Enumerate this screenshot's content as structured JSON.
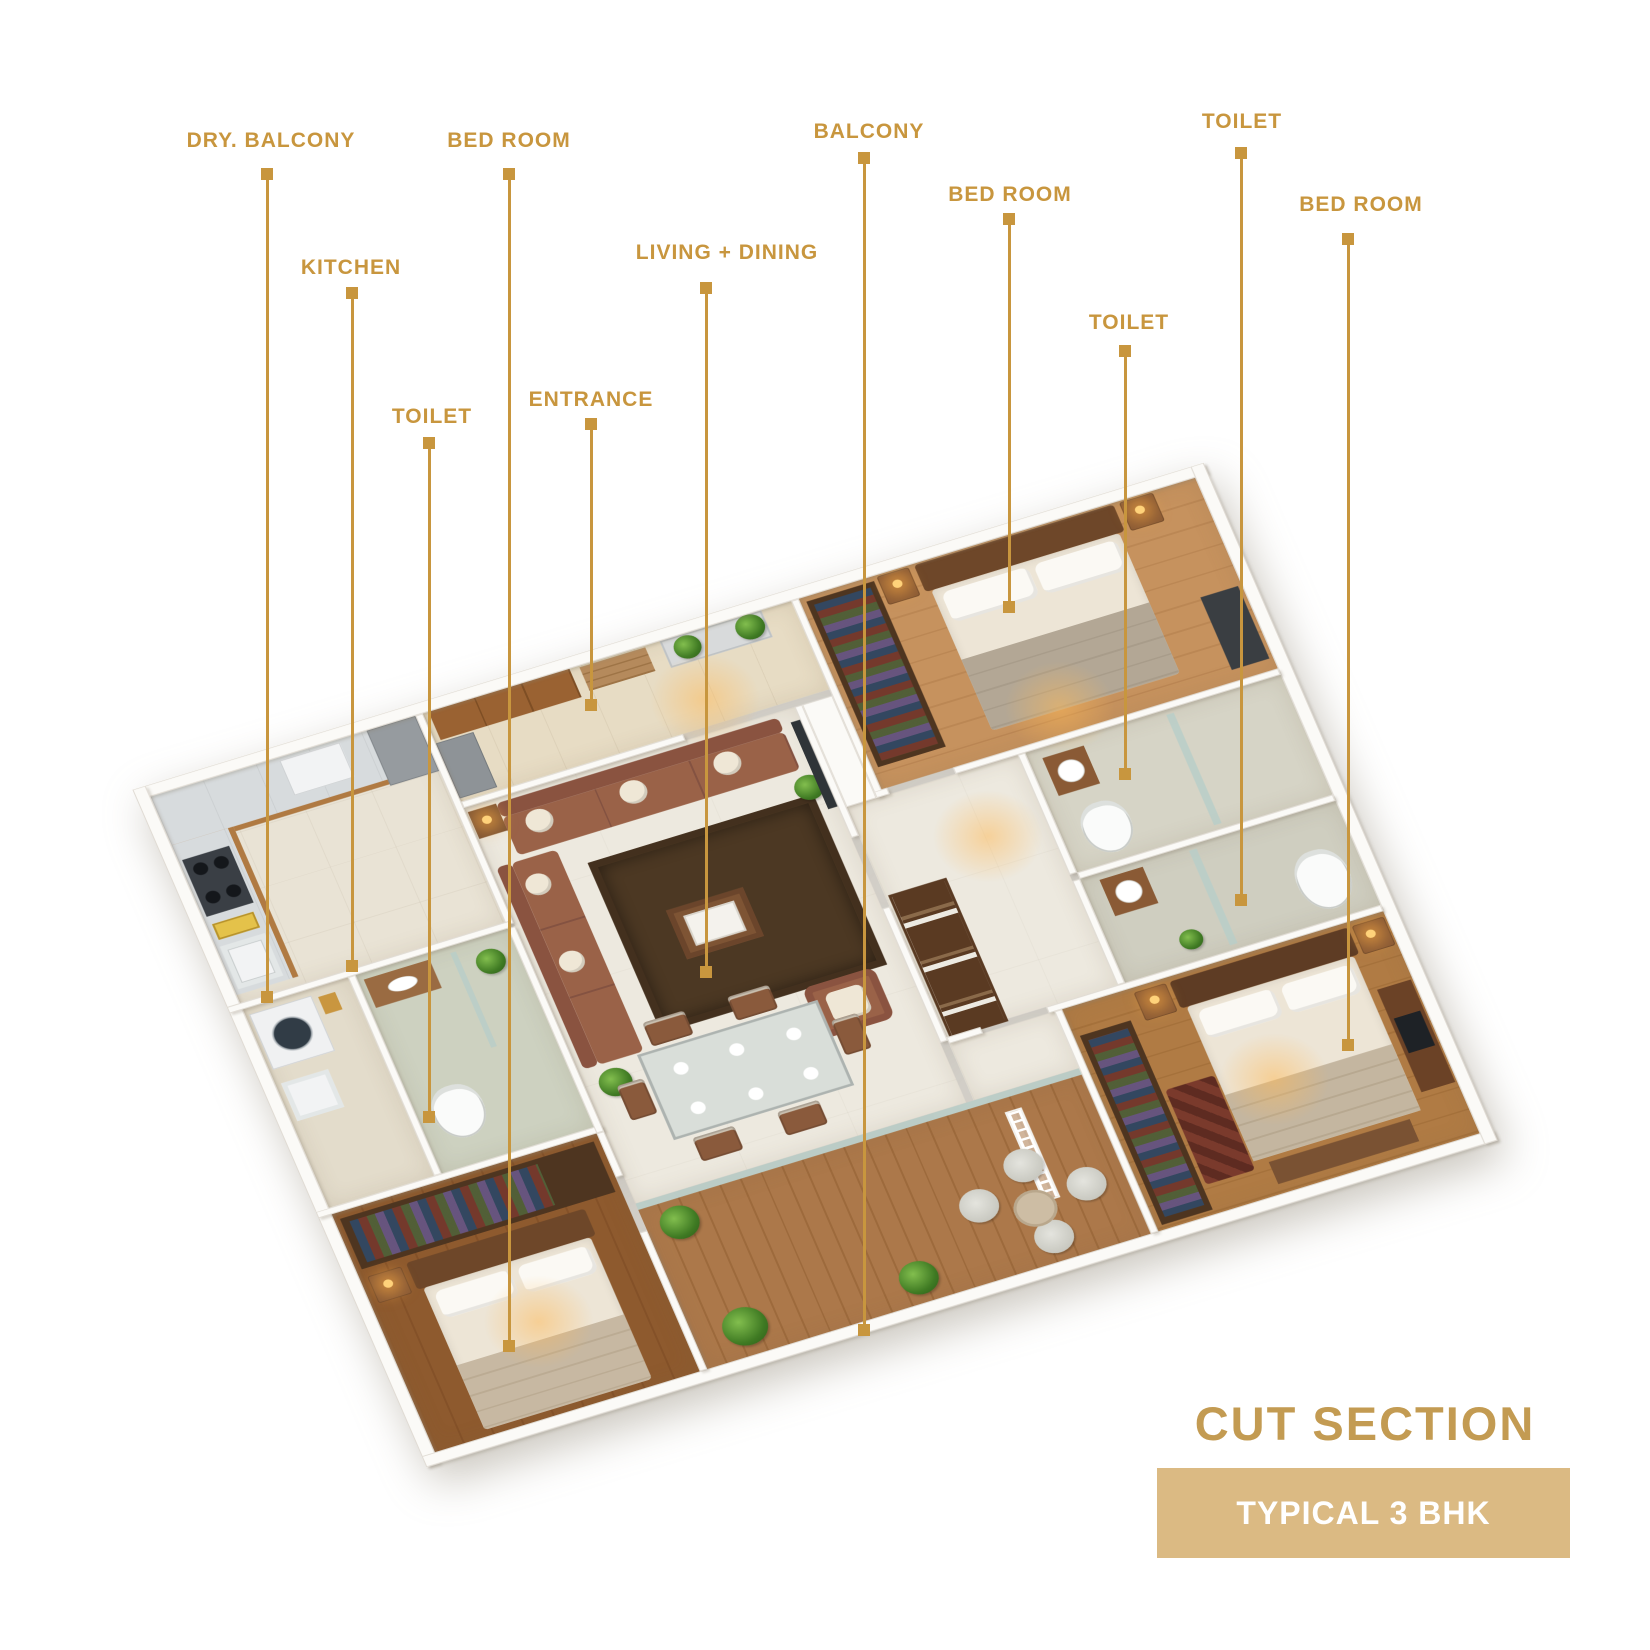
{
  "page": {
    "title": "CUT SECTION",
    "badge_label": "TYPICAL 3 BHK"
  },
  "colors": {
    "label_gold": "#C8963E",
    "title_gold": "#C39B52",
    "badge_bg": "#DBBA83",
    "badge_text": "#FFFFFF",
    "background": "#FFFFFF"
  },
  "labels": [
    {
      "text": "DRY. BALCONY",
      "x": 271,
      "label_y": 141,
      "line_x": 267,
      "top": 168,
      "bottom": 997
    },
    {
      "text": "KITCHEN",
      "x": 351,
      "label_y": 268,
      "line_x": 352,
      "top": 287,
      "bottom": 966
    },
    {
      "text": "TOILET",
      "x": 432,
      "label_y": 417,
      "line_x": 429,
      "top": 437,
      "bottom": 1117
    },
    {
      "text": "BED ROOM",
      "x": 509,
      "label_y": 141,
      "line_x": 509,
      "top": 168,
      "bottom": 1346
    },
    {
      "text": "ENTRANCE",
      "x": 591,
      "label_y": 400,
      "line_x": 591,
      "top": 418,
      "bottom": 705
    },
    {
      "text": "LIVING + DINING",
      "x": 727,
      "label_y": 253,
      "line_x": 706,
      "top": 282,
      "bottom": 972
    },
    {
      "text": "BALCONY",
      "x": 869,
      "label_y": 132,
      "line_x": 864,
      "top": 152,
      "bottom": 1330
    },
    {
      "text": "BED ROOM",
      "x": 1010,
      "label_y": 195,
      "line_x": 1009,
      "top": 213,
      "bottom": 607
    },
    {
      "text": "TOILET",
      "x": 1129,
      "label_y": 323,
      "line_x": 1125,
      "top": 345,
      "bottom": 774
    },
    {
      "text": "TOILET",
      "x": 1242,
      "label_y": 122,
      "line_x": 1241,
      "top": 147,
      "bottom": 900
    },
    {
      "text": "BED ROOM",
      "x": 1361,
      "label_y": 205,
      "line_x": 1348,
      "top": 233,
      "bottom": 1045
    }
  ]
}
